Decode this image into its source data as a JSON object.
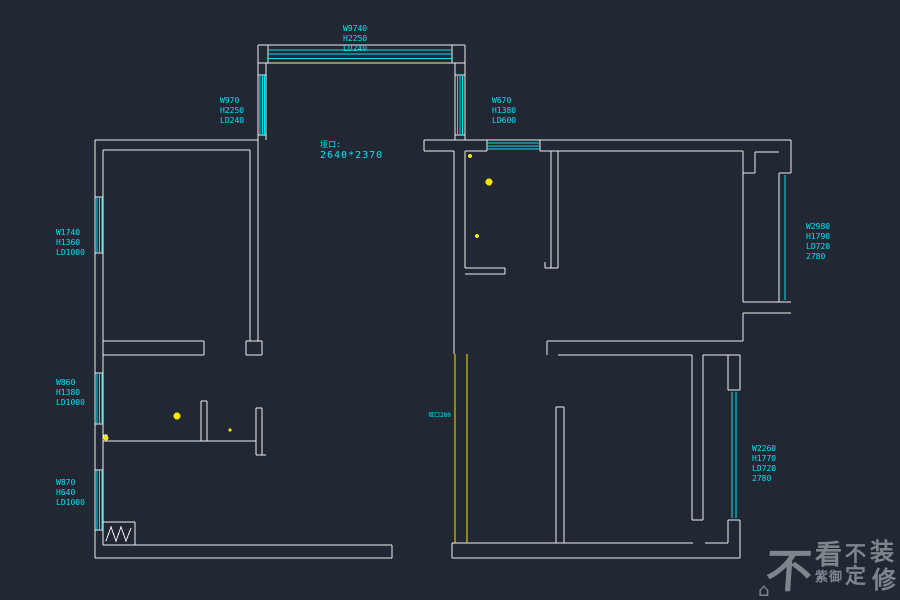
{
  "title": "apartment-floor-plan",
  "colors": {
    "background": "#212833",
    "wall": "#f0f0f0",
    "window_hatch": "#00e4f4",
    "label_text": "#00e4f4",
    "highlight_wall": "#f7e400",
    "fixture_mark": "#f7e400",
    "watermark": "#878d94"
  },
  "labels": {
    "top": [
      "W9740",
      "H2250",
      "LD240"
    ],
    "bay_left": [
      "W970",
      "H2250",
      "LD240"
    ],
    "top_right": [
      "W670",
      "H1380",
      "LD600"
    ],
    "left_upper": [
      "W1740",
      "H1360",
      "LD1000"
    ],
    "left_middle": [
      "W860",
      "H1380",
      "LD1000"
    ],
    "left_lower": [
      "W870",
      "H640",
      "LD1000"
    ],
    "right_upper": [
      "W2980",
      "H1790",
      "LD720",
      "2780"
    ],
    "right_lower": [
      "W2260",
      "H1770",
      "LD720",
      "2780"
    ]
  },
  "opening": {
    "title": "垭口:",
    "size": "2640*2370"
  },
  "wall_note": "垭口280",
  "watermark": {
    "char_1": "不",
    "char_2": "看",
    "char_2_sub": "紫御",
    "char_3": "不",
    "char_3_sub": "定",
    "char_4": "装",
    "char_4_sub": "修",
    "house_icon": "⌂"
  }
}
